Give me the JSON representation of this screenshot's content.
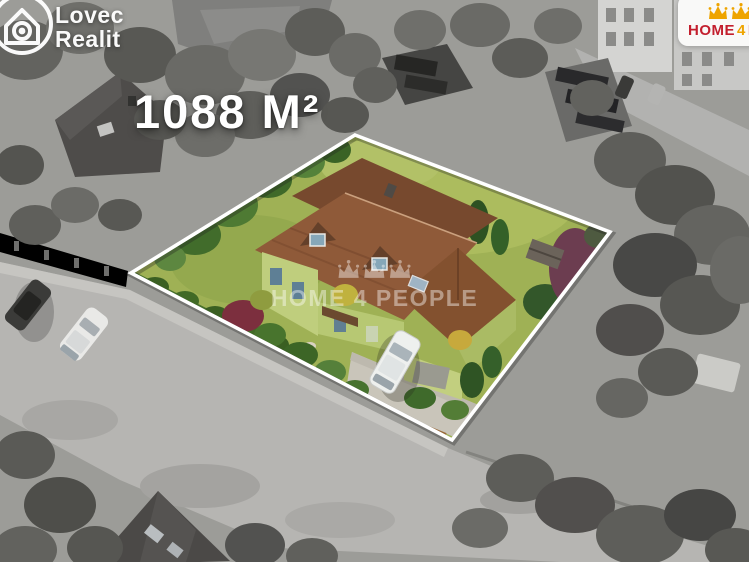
{
  "listing": {
    "area_label": "1088 M²"
  },
  "agency_logo": {
    "name_line1": "Lovec",
    "name_line2": "Realit"
  },
  "partner_logo": {
    "word_home": "HOME",
    "word_4": "4",
    "word_people": "PEOPLE"
  },
  "watermark": {
    "text": "HOME 4 PEOPLE"
  },
  "colors": {
    "brand-red": "#c31f2e",
    "brand-gold": "#eea400",
    "overlay-white": "#ffffff",
    "boundary-white": "#ffffff"
  }
}
